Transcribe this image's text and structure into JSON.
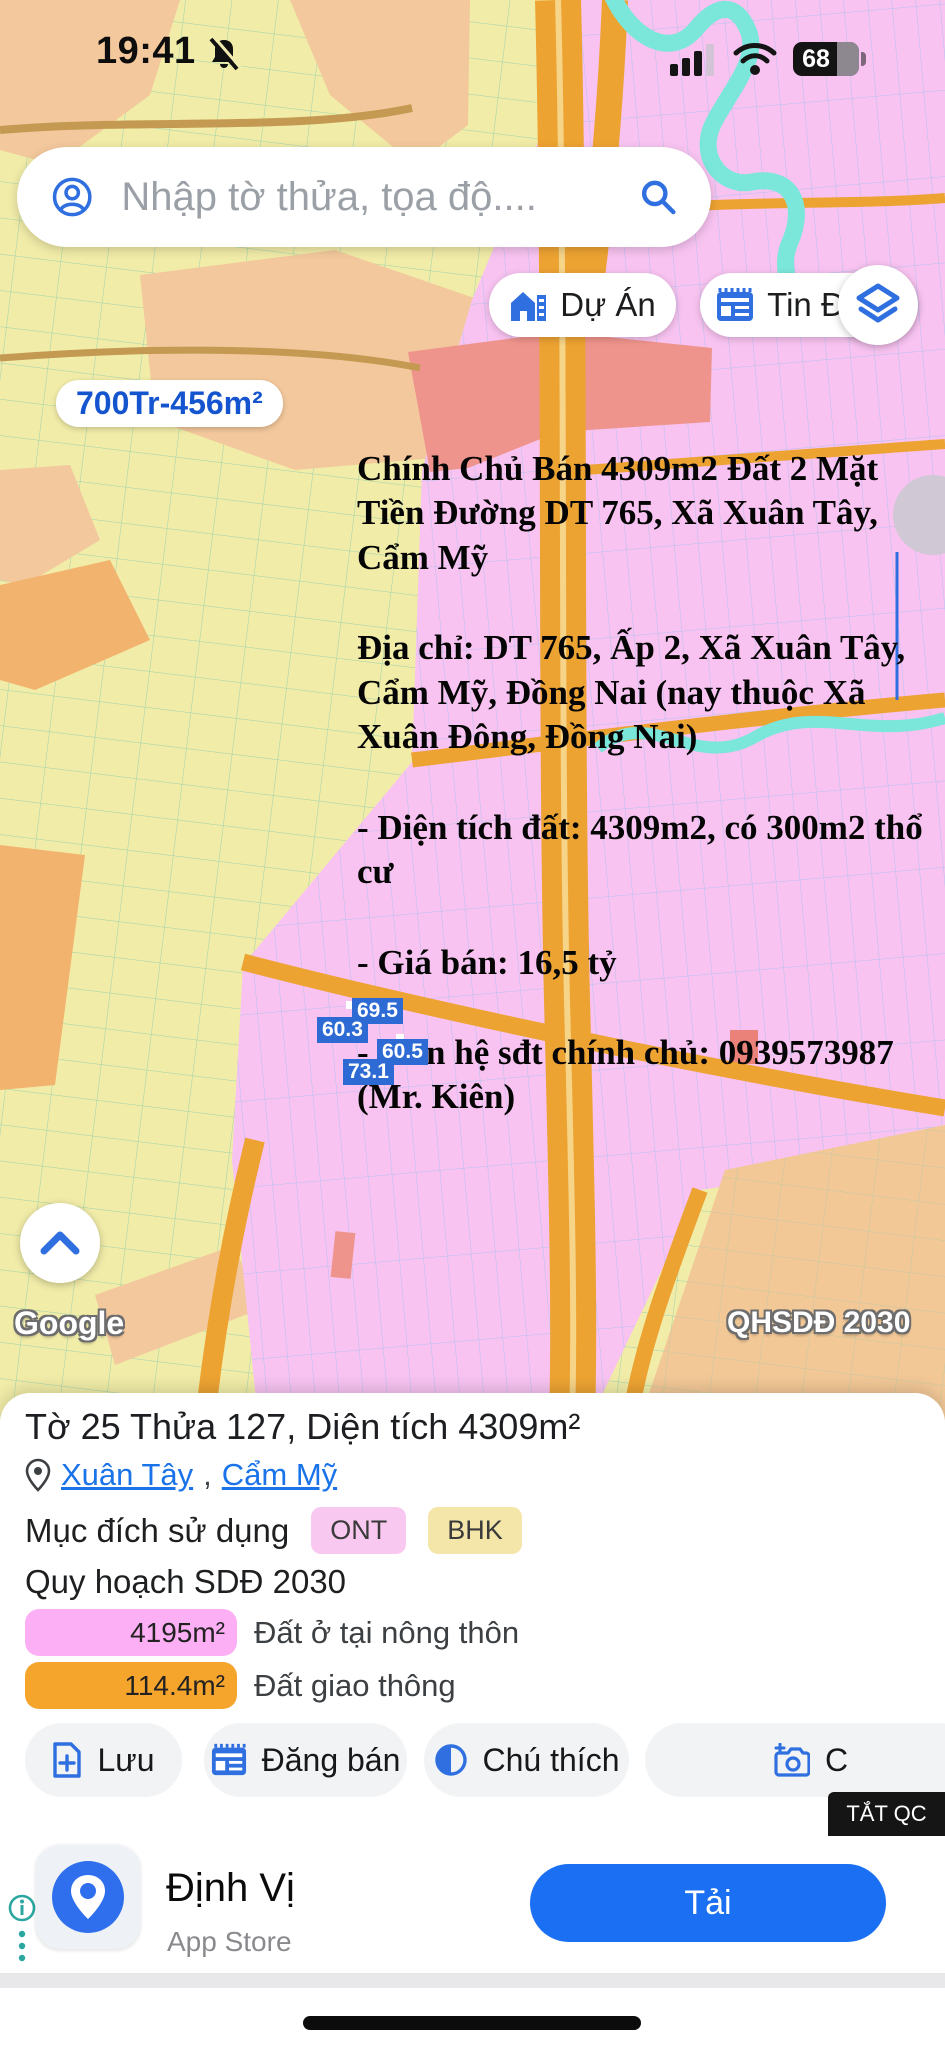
{
  "status_bar": {
    "time": "19:41",
    "battery_percent": "68"
  },
  "search": {
    "placeholder": "Nhập tờ thửa, tọa độ...."
  },
  "map_buttons": {
    "du_an": "Dự Án",
    "tin_dang": "Tin Đăng"
  },
  "map": {
    "price_label": "700Tr-456m²",
    "parcel_labels": [
      "69.5",
      "60.3",
      "60.5",
      "73.1"
    ],
    "google_watermark": "Google",
    "plan_watermark": "QHSDĐ 2030",
    "listing_overlay": {
      "para1": "Chính Chủ Bán 4309m2 Đất 2 Mặt Tiền Đường DT 765, Xã Xuân Tây, Cẩm Mỹ",
      "para2": "Địa chỉ: DT 765, Ấp 2, Xã Xuân Tây, Cẩm Mỹ, Đồng Nai (nay thuộc Xã Xuân Đông, Đồng Nai)",
      "para3": "- Diện tích đất: 4309m2, có 300m2 thổ cư",
      "para4": "- Giá bán: 16,5 tỷ",
      "para5": "- Liên hệ sđt chính chủ: 0939573987 (Mr. Kiên)"
    }
  },
  "panel": {
    "title": "Tờ 25 Thửa 127, Diện tích 4309m²",
    "location": {
      "part1": "Xuân Tây",
      "comma": ",",
      "part2": "Cẩm Mỹ"
    },
    "usage_label": "Mục đích sử dụng",
    "usage_tags": [
      {
        "label": "ONT",
        "bg": "#f9c8f1"
      },
      {
        "label": "BHK",
        "bg": "#f4e6a9"
      }
    ],
    "planning_title": "Quy hoạch SDĐ 2030",
    "legend": [
      {
        "area": "4195m²",
        "label": "Đất ở tại nông thôn",
        "color": "#fcaff4"
      },
      {
        "area": "114.4m²",
        "label": "Đất giao thông",
        "color": "#f5a42c"
      }
    ],
    "actions": [
      {
        "label": "Lưu"
      },
      {
        "label": "Đăng bán"
      },
      {
        "label": "Chú thích"
      },
      {
        "label": "C"
      }
    ],
    "dismiss_ad": "TẮT QC"
  },
  "ad": {
    "app_name": "Định Vị",
    "store": "App Store",
    "cta": "Tải"
  },
  "colors": {
    "accent_blue": "#1a73e8",
    "price_blue": "#1455cf",
    "parcel_label_bg": "#2d6ad4",
    "map_yellow": "#f1eca8",
    "map_pink": "#f8c3f1",
    "map_road_orange": "#eda332",
    "map_river_teal": "#7be6da",
    "legend_pink": "#fcaff4",
    "legend_orange": "#f5a42c",
    "cta_blue": "#1a6ff2"
  }
}
